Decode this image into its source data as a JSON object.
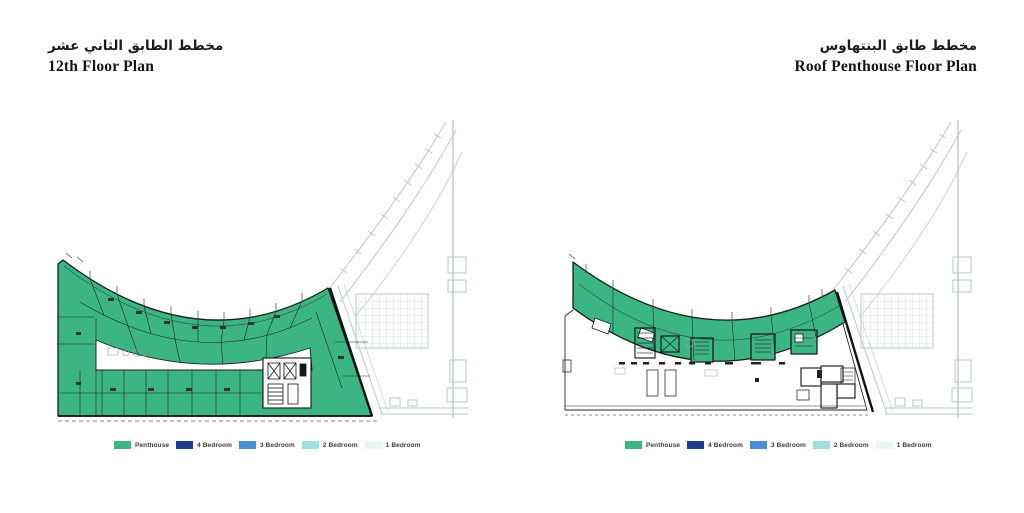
{
  "plans": {
    "left": {
      "title_ar": "مخطط الطابق الثاني عشر",
      "title_en": "12th Floor Plan"
    },
    "right": {
      "title_ar": "مخطط طابق البنتهاوس",
      "title_en": "Roof Penthouse Floor Plan"
    }
  },
  "legend": {
    "items": [
      {
        "label": "Penthouse",
        "color": "#3CB585"
      },
      {
        "label": "4 Bedroom",
        "color": "#1D3C8C"
      },
      {
        "label": "3 Bedroom",
        "color": "#4A90D9"
      },
      {
        "label": "2 Bedroom",
        "color": "#9FE0DF"
      },
      {
        "label": "1 Bedroom",
        "color": "#E7F8F2"
      }
    ]
  },
  "colors": {
    "penthouse_green": "#3CB585",
    "plan_line_light": "#b9cac7",
    "plan_line_dark": "#1b1b1b"
  }
}
